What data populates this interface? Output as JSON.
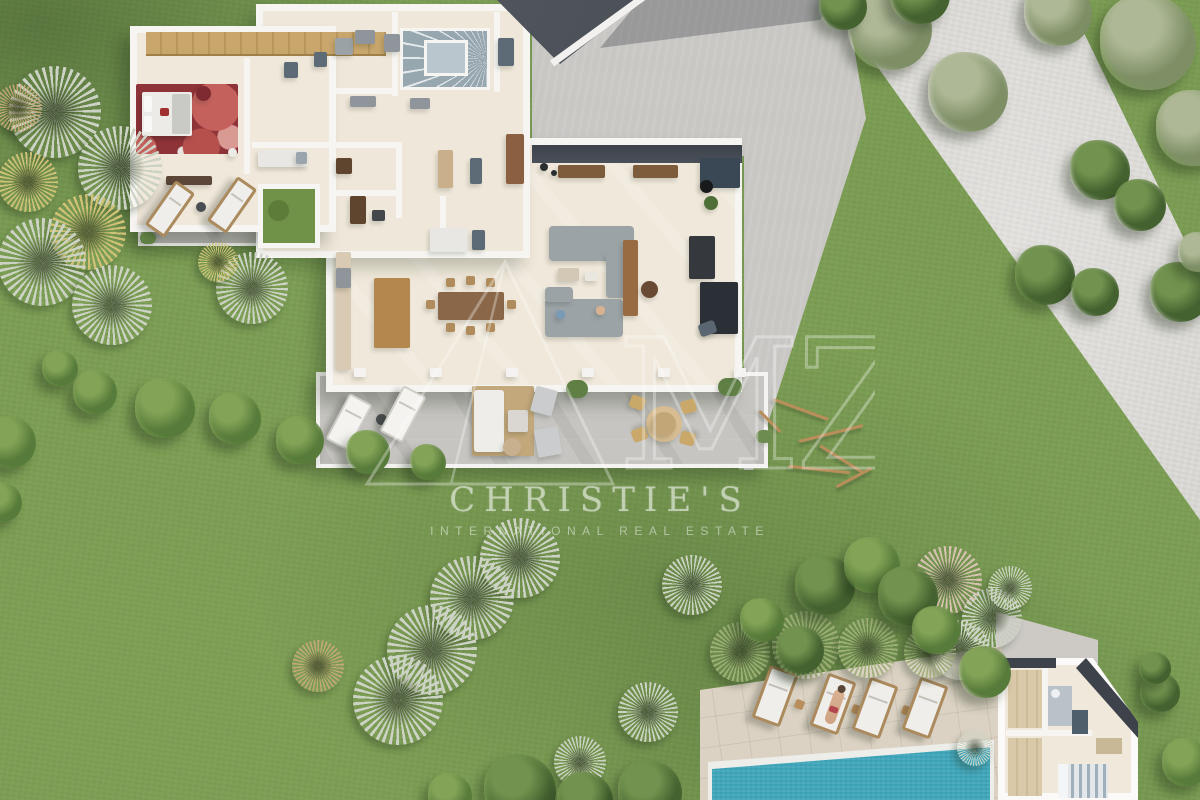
{
  "watermarks": {
    "brand_line1": "CHRISTIE'S",
    "brand_line2": "INTERNATIONAL REAL ESTATE",
    "logo_text": "MZ"
  },
  "palette": {
    "grass": "#7c9e54",
    "driveway_concrete": "#d8d6d2",
    "courtyard_concrete": "#c9c7c4",
    "terrace_stone": "#c7c5c1",
    "pool_deck": "#dbd2c3",
    "pool_water": "#3fa6ba",
    "floor_cream": "#f0e8da",
    "wall_white": "#f6f5f2",
    "roof_dark": "#474c54",
    "bedroom_rug_red": "#8e3338",
    "wood_furniture": "#b3874e",
    "watermark_white": "#f8f9f6"
  },
  "scene": {
    "palm_tones": {
      "silver": "#cdd3c4",
      "gold": "#cfc276",
      "dry": "#c4a878",
      "green": "#9fb07a",
      "pink": "#d8c3b2"
    },
    "tree_tones": {
      "olive": [
        "#aeb896",
        "#7e8f66"
      ],
      "pine": [
        "#72934f",
        "#44622f"
      ],
      "bush": [
        "#83a457",
        "#577b3a"
      ]
    },
    "palms": [
      [
        55,
        112,
        46,
        "silver"
      ],
      [
        120,
        168,
        42,
        "silver"
      ],
      [
        28,
        182,
        30,
        "gold"
      ],
      [
        88,
        232,
        38,
        "gold"
      ],
      [
        42,
        262,
        44,
        "silver"
      ],
      [
        112,
        305,
        40,
        "silver"
      ],
      [
        18,
        108,
        24,
        "dry"
      ],
      [
        252,
        288,
        36,
        "silver"
      ],
      [
        218,
        262,
        20,
        "gold"
      ],
      [
        520,
        558,
        40,
        "silver"
      ],
      [
        472,
        598,
        42,
        "silver"
      ],
      [
        432,
        650,
        45,
        "silver"
      ],
      [
        398,
        700,
        45,
        "silver"
      ],
      [
        318,
        666,
        26,
        "dry"
      ],
      [
        692,
        585,
        30,
        "silver"
      ],
      [
        648,
        712,
        30,
        "silver"
      ],
      [
        580,
        762,
        26,
        "silver"
      ],
      [
        948,
        580,
        34,
        "pink"
      ],
      [
        992,
        618,
        30,
        "silver"
      ],
      [
        960,
        650,
        30,
        "silver"
      ],
      [
        1010,
        588,
        22,
        "silver"
      ],
      [
        975,
        748,
        18,
        "silver"
      ],
      [
        740,
        652,
        30,
        "green"
      ],
      [
        806,
        645,
        34,
        "green"
      ],
      [
        868,
        648,
        30,
        "green"
      ],
      [
        930,
        652,
        26,
        "green"
      ]
    ],
    "trees": [
      [
        890,
        28,
        42,
        "olive"
      ],
      [
        968,
        92,
        40,
        "olive"
      ],
      [
        1058,
        12,
        34,
        "olive"
      ],
      [
        1148,
        42,
        48,
        "olive"
      ],
      [
        1194,
        128,
        38,
        "olive"
      ],
      [
        843,
        6,
        24,
        "pine"
      ],
      [
        920,
        -6,
        30,
        "pine"
      ],
      [
        1100,
        170,
        30,
        "pine"
      ],
      [
        1140,
        205,
        26,
        "pine"
      ],
      [
        1045,
        275,
        30,
        "pine"
      ],
      [
        1095,
        292,
        24,
        "pine"
      ],
      [
        1180,
        292,
        30,
        "pine"
      ],
      [
        1198,
        252,
        20,
        "olive"
      ],
      [
        165,
        408,
        30,
        "bush"
      ],
      [
        235,
        418,
        26,
        "bush"
      ],
      [
        300,
        440,
        24,
        "bush"
      ],
      [
        368,
        452,
        22,
        "bush"
      ],
      [
        428,
        462,
        18,
        "bush"
      ],
      [
        95,
        392,
        22,
        "bush"
      ],
      [
        10,
        442,
        26,
        "bush"
      ],
      [
        2,
        502,
        20,
        "bush"
      ],
      [
        60,
        368,
        18,
        "bush"
      ],
      [
        825,
        585,
        30,
        "pine"
      ],
      [
        872,
        565,
        28,
        "bush"
      ],
      [
        908,
        596,
        30,
        "pine"
      ],
      [
        762,
        620,
        22,
        "bush"
      ],
      [
        800,
        650,
        24,
        "pine"
      ],
      [
        936,
        630,
        24,
        "bush"
      ],
      [
        985,
        672,
        26,
        "bush"
      ],
      [
        520,
        790,
        36,
        "pine"
      ],
      [
        585,
        800,
        28,
        "pine"
      ],
      [
        650,
        792,
        32,
        "pine"
      ],
      [
        450,
        795,
        22,
        "bush"
      ],
      [
        1160,
        692,
        20,
        "pine"
      ],
      [
        1186,
        762,
        24,
        "bush"
      ],
      [
        1155,
        668,
        16,
        "pine"
      ]
    ],
    "branches": [
      [
        772,
        408,
        58,
        20
      ],
      [
        798,
        432,
        66,
        -14
      ],
      [
        816,
        458,
        52,
        32
      ],
      [
        788,
        468,
        62,
        6
      ],
      [
        834,
        476,
        40,
        -28
      ],
      [
        755,
        420,
        30,
        45
      ]
    ],
    "interior_walls": [
      [
        244,
        58,
        6,
        116
      ],
      [
        252,
        142,
        146,
        6
      ],
      [
        392,
        12,
        6,
        84
      ],
      [
        494,
        12,
        6,
        80
      ],
      [
        336,
        88,
        60,
        6
      ],
      [
        336,
        190,
        62,
        6
      ],
      [
        396,
        142,
        6,
        76
      ],
      [
        440,
        196,
        6,
        58
      ]
    ],
    "fixtures": [
      [
        166,
        176,
        46,
        9,
        "#5b4637",
        0,
        2
      ],
      [
        196,
        86,
        15,
        15,
        "#7e2a30",
        0,
        8
      ],
      [
        228,
        148,
        9,
        9,
        "#ecebe7",
        0,
        5
      ],
      [
        284,
        62,
        14,
        16,
        "#5d6b76",
        0,
        2
      ],
      [
        314,
        52,
        13,
        15,
        "#5d6b76",
        0,
        2
      ],
      [
        258,
        150,
        50,
        17,
        "#e9e7e3",
        0,
        2
      ],
      [
        296,
        152,
        11,
        12,
        "#9aa4ac",
        0,
        2
      ],
      [
        336,
        158,
        16,
        16,
        "#5f452e",
        0,
        2
      ],
      [
        335,
        38,
        18,
        17,
        "#9aa2a6",
        0,
        2
      ],
      [
        355,
        30,
        20,
        14,
        "#8f959a",
        0,
        2
      ],
      [
        384,
        34,
        16,
        18,
        "#8f959a",
        0,
        2
      ],
      [
        350,
        96,
        26,
        11,
        "#8f959a",
        0,
        2
      ],
      [
        410,
        98,
        20,
        11,
        "#8f959a",
        0,
        2
      ],
      [
        498,
        38,
        16,
        28,
        "#5d6b76",
        0,
        2
      ],
      [
        350,
        196,
        16,
        28,
        "#5f452e",
        0,
        2
      ],
      [
        372,
        210,
        13,
        11,
        "#43474c",
        0,
        2
      ],
      [
        438,
        150,
        15,
        38,
        "#c9b08a",
        0,
        2
      ],
      [
        470,
        158,
        12,
        26,
        "#5d6b76",
        0,
        2
      ],
      [
        430,
        228,
        38,
        24,
        "#e9e7e3",
        0,
        2
      ],
      [
        472,
        230,
        13,
        20,
        "#5d6b76",
        0,
        2
      ],
      [
        506,
        134,
        18,
        50,
        "#8a6040",
        0,
        2
      ],
      [
        540,
        163,
        8,
        8,
        "#2b2e31",
        0,
        4
      ],
      [
        551,
        170,
        6,
        6,
        "#2b2e31",
        0,
        3
      ],
      [
        336,
        252,
        15,
        118,
        "#d9cab3",
        0,
        2
      ],
      [
        336,
        268,
        15,
        20,
        "#8f959a",
        0,
        2
      ],
      [
        374,
        278,
        36,
        70,
        "#b3874e",
        0,
        2
      ],
      [
        438,
        292,
        66,
        28,
        "#8a6748",
        0,
        2
      ],
      [
        446,
        278,
        9,
        9,
        "#b08c5c",
        0,
        2
      ],
      [
        466,
        276,
        9,
        9,
        "#b08c5c",
        0,
        2
      ],
      [
        486,
        278,
        9,
        9,
        "#b08c5c",
        0,
        2
      ],
      [
        446,
        323,
        9,
        9,
        "#b08c5c",
        0,
        2
      ],
      [
        466,
        326,
        9,
        9,
        "#b08c5c",
        0,
        2
      ],
      [
        486,
        323,
        9,
        9,
        "#b08c5c",
        0,
        2
      ],
      [
        426,
        300,
        9,
        9,
        "#b08c5c",
        0,
        2
      ],
      [
        507,
        300,
        9,
        9,
        "#b08c5c",
        0,
        2
      ],
      [
        549,
        226,
        85,
        35,
        "#9ba3a7",
        0,
        4
      ],
      [
        606,
        253,
        28,
        45,
        "#9ba3a7",
        0,
        4
      ],
      [
        545,
        299,
        78,
        38,
        "#9ba3a7",
        0,
        4
      ],
      [
        545,
        287,
        28,
        15,
        "#9ba3a7",
        0,
        4
      ],
      [
        623,
        240,
        15,
        76,
        "#996b42",
        0,
        2
      ],
      [
        558,
        165,
        47,
        13,
        "#7d5c3c",
        0,
        2
      ],
      [
        633,
        165,
        45,
        13,
        "#7d5c3c",
        0,
        2
      ],
      [
        689,
        236,
        26,
        43,
        "#35383d",
        0,
        2
      ],
      [
        700,
        282,
        38,
        52,
        "#2b3036",
        0,
        2
      ],
      [
        700,
        158,
        40,
        30,
        "#3a4754",
        0,
        2
      ],
      [
        699,
        322,
        17,
        13,
        "#5a6672",
        -20,
        3
      ],
      [
        558,
        268,
        21,
        13,
        "#d3c8b6",
        0,
        2
      ],
      [
        585,
        272,
        13,
        9,
        "#eae7e1",
        0,
        2
      ],
      [
        641,
        281,
        17,
        17,
        "#6b4a34",
        0,
        9
      ],
      [
        700,
        180,
        13,
        13,
        "#17191b",
        0,
        7
      ],
      [
        704,
        196,
        14,
        14,
        "#4e7038",
        0,
        7
      ],
      [
        556,
        310,
        9,
        9,
        "#7a9ab5",
        0,
        4
      ],
      [
        596,
        306,
        9,
        9,
        "#d8b290",
        0,
        4
      ],
      [
        376,
        414,
        11,
        11,
        "#4a4e52",
        0,
        6
      ],
      [
        472,
        386,
        62,
        70,
        "#c3a87c",
        0,
        2
      ],
      [
        474,
        390,
        30,
        62,
        "#eeede9",
        0,
        3
      ],
      [
        508,
        410,
        20,
        22,
        "#dad7d2",
        0,
        2
      ],
      [
        503,
        438,
        18,
        18,
        "#c7b08e",
        0,
        9
      ],
      [
        533,
        388,
        22,
        26,
        "#caccce",
        15,
        2
      ],
      [
        536,
        428,
        24,
        28,
        "#caccce",
        -10,
        2
      ],
      [
        566,
        380,
        22,
        18,
        "#5f7f44",
        0,
        10
      ],
      [
        718,
        378,
        24,
        18,
        "#5f7f44",
        0,
        10
      ],
      [
        756,
        430,
        16,
        13,
        "#6d8c4f",
        0,
        8
      ],
      [
        646,
        406,
        36,
        36,
        "#d8bd92",
        0,
        18
      ],
      [
        652,
        412,
        24,
        24,
        "#c2a678",
        0,
        12
      ],
      [
        630,
        396,
        15,
        13,
        "#c9a86a",
        20,
        3
      ],
      [
        681,
        400,
        15,
        13,
        "#c9a86a",
        -15,
        3
      ],
      [
        632,
        428,
        15,
        13,
        "#c9a86a",
        160,
        3
      ],
      [
        680,
        432,
        15,
        13,
        "#c9a86a",
        195,
        3
      ],
      [
        354,
        368,
        12,
        9,
        "#f4f3f1",
        0,
        1
      ],
      [
        430,
        368,
        12,
        9,
        "#f4f3f1",
        0,
        1
      ],
      [
        506,
        368,
        12,
        9,
        "#f4f3f1",
        0,
        1
      ],
      [
        582,
        368,
        12,
        9,
        "#f4f3f1",
        0,
        1
      ],
      [
        658,
        368,
        12,
        9,
        "#f4f3f1",
        0,
        1
      ],
      [
        734,
        368,
        12,
        9,
        "#f4f3f1",
        0,
        1
      ],
      [
        196,
        202,
        10,
        10,
        "#4a4e52",
        0,
        5
      ],
      [
        140,
        232,
        16,
        12,
        "#5f7f44",
        0,
        8
      ],
      [
        795,
        700,
        9,
        9,
        "#b98e5a",
        20,
        2
      ],
      [
        852,
        705,
        9,
        9,
        "#b98e5a",
        20,
        2
      ],
      [
        902,
        706,
        9,
        9,
        "#b98e5a",
        20,
        2
      ]
    ],
    "loungers": [
      [
        158,
        182,
        24,
        54,
        35,
        "wood",
        0
      ],
      [
        220,
        178,
        24,
        54,
        35,
        "wood",
        0
      ],
      [
        336,
        396,
        26,
        52,
        28,
        "white",
        0
      ],
      [
        390,
        388,
        26,
        52,
        28,
        "white",
        0
      ],
      [
        760,
        668,
        30,
        56,
        20,
        "wood",
        0
      ],
      [
        818,
        676,
        30,
        56,
        20,
        "wood",
        1
      ],
      [
        860,
        680,
        30,
        56,
        20,
        "wood",
        0
      ],
      [
        910,
        680,
        30,
        56,
        20,
        "wood",
        0
      ]
    ]
  }
}
